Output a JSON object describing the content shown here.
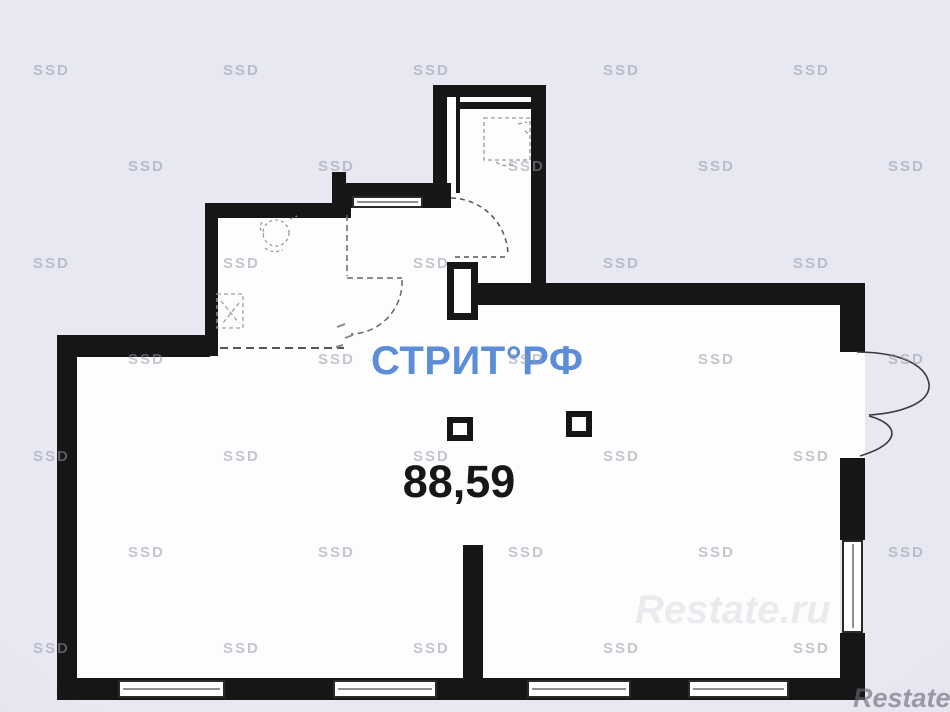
{
  "plan": {
    "area_label": "88,59",
    "brand_logo": "СТРИТ°РФ",
    "brand_color": "#5b8ed6",
    "wall_color": "#161616",
    "floor_color": "#fdfdfd",
    "background_color": "#e8e8f2"
  },
  "watermarks": {
    "tile_text": "SSD",
    "grid": {
      "rows": [
        {
          "y": 62,
          "xs": [
            33,
            223,
            413,
            603,
            793
          ]
        },
        {
          "y": 158,
          "xs": [
            128,
            318,
            508,
            698,
            888
          ]
        },
        {
          "y": 255,
          "xs": [
            33,
            223,
            413,
            603,
            793
          ]
        },
        {
          "y": 351,
          "xs": [
            128,
            318,
            508,
            698,
            888
          ]
        },
        {
          "y": 448,
          "xs": [
            33,
            223,
            413,
            603,
            793
          ]
        },
        {
          "y": 544,
          "xs": [
            128,
            318,
            508,
            698,
            888
          ]
        },
        {
          "y": 640,
          "xs": [
            33,
            223,
            413,
            603,
            793
          ]
        }
      ]
    },
    "corner_text": "Restate.ru",
    "faint_text": "Restate.ru"
  }
}
